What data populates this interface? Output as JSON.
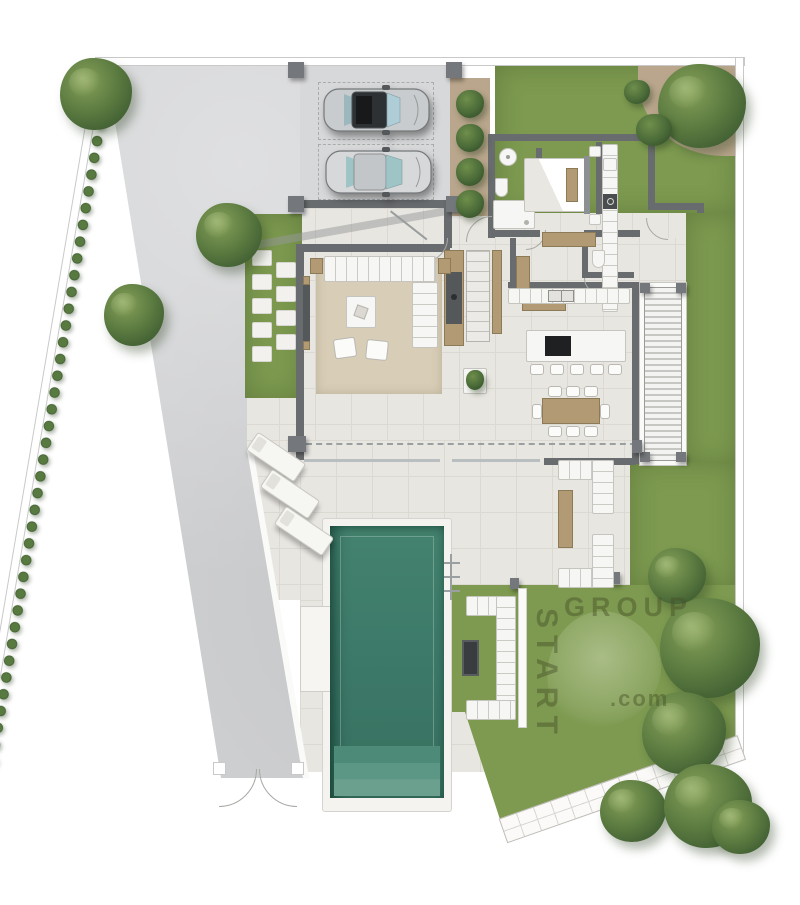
{
  "watermark": {
    "vertical": "START",
    "horizontal": "GROUP",
    "suffix": ".com"
  },
  "palette": {
    "lawn": "#7d9a50",
    "tree_dark": "#35522c",
    "tree_mid": "#5a7a40",
    "tree_light": "#86a058",
    "pool": "#3d7b6a",
    "pool_steps": "#6ba08f",
    "driveway": "#d1d2d4",
    "terrace": "#e8e6e1",
    "tile_line": "#dcd9d2",
    "wall": "#696c6e",
    "glass": "#b9bec0",
    "wood": "#b19a74",
    "rug": "#d8cdb6",
    "tan": "#b9a68c",
    "fixture_white": "#f6f6f4",
    "watermark": "rgba(70,80,40,0.45)",
    "fence_line": "#c9c9c9",
    "car_body": "#c9ccce",
    "car_roof": "#2e3134",
    "car_glass": "#aecdd6",
    "car2_glass": "#9fc4c6"
  },
  "scene": {
    "type": "villa ground floor plan, top view render",
    "outdoor_elements": {
      "cars": 2,
      "carport_pillars": 4,
      "sun_loungers": 3,
      "planter_shrubs": 4,
      "pool": "rectangular pool with bottom steps and side ledge",
      "gate": "double swing gate at bottom of driveway",
      "garden_sofa": "C-shaped modular sofa with fire pit",
      "lounge": "two L-shaped sofas with wooden table"
    },
    "rooms": [
      "carport",
      "entry",
      "living-room",
      "staircase",
      "fireplace",
      "kitchen",
      "kitchen-island",
      "dining",
      "hallway",
      "wc",
      "bathroom",
      "bedroom",
      "laundry-counter",
      "louvered-deck",
      "terrace",
      "garden"
    ],
    "kitchen_bar_stools": 5,
    "dining_chairs": 8
  }
}
